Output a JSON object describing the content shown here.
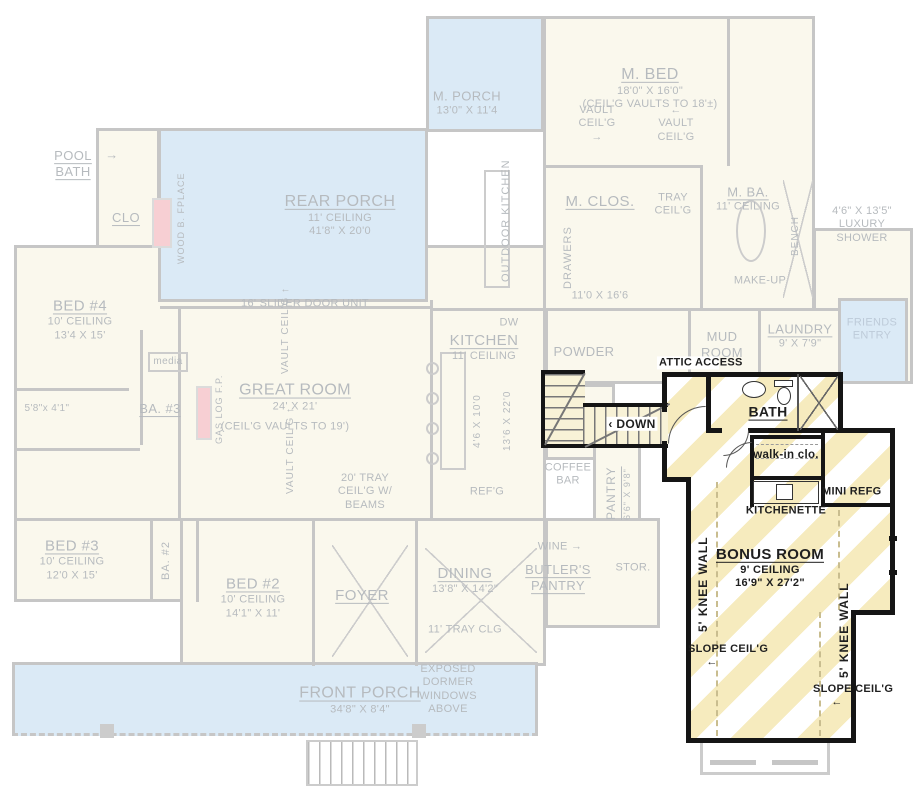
{
  "colors": {
    "highlight_stripe": "#f6ebbe",
    "porch_blue": "#d9e9f6",
    "faded_wall": "#c7c7c7",
    "active_wall": "#151515",
    "fireplace_pink": "#f7ced2",
    "faded_text": "#b8bcbf",
    "active_text": "#1f1f1f"
  },
  "icons": {
    "arrow_right": "→",
    "arrow_left": "←",
    "arrow_up": "↑",
    "arrow_down": "↓",
    "chevron_left": "‹"
  },
  "faded": {
    "m_porch_name": "M. PORCH",
    "m_porch_dims": "13'0\" X 11'4",
    "m_bed_name": "M. BED",
    "m_bed_dims": "18'0\" X 16'0\"",
    "m_bed_note": "(CEIL'G VAULTS TO 18'±)",
    "vault_ceilg": "VAULT CEIL'G",
    "pool_bath": "POOL BATH",
    "clo": "CLO",
    "wood_fplace": "WOOD B. FPLACE",
    "rear_porch_name": "REAR PORCH",
    "rear_porch_ceiling": "11' CEILING",
    "rear_porch_dims": "41'8\" X 20'0",
    "outdoor_kitchen": "OUTDOOR KITCHEN",
    "m_clos_name": "M. CLOS.",
    "drawers": "DRAWERS",
    "m_clos_dims": "11'0 X 16'6",
    "tray_ceilg": "TRAY CEIL'G",
    "m_ba_name": "M. BA.",
    "m_ba_ceiling": "11' CEILING",
    "bench": "BENCH",
    "make_up": "MAKE-UP",
    "shower_note": "4'6\" X 13'5\" LUXURY SHOWER",
    "bed4_name": "BED #4",
    "bed4_ceiling": "10' CEILING",
    "bed4_dims": "13'4 X 15'",
    "slider": "16' SLIDER DOOR UNIT",
    "media": "media",
    "great_room_name": "GREAT ROOM",
    "great_room_dims": "24' X 21'",
    "great_room_note": "(CEIL'G VAULTS TO 19')",
    "ba3_dims": "5'8\"x 4'1\"",
    "ba3_name": "BA. #3",
    "gas_fp": "GAS LOG F.P.",
    "kitchen_name": "KITCHEN",
    "kitchen_ceiling": "11' CEILING",
    "dw": "DW",
    "kitchen_island_dims": "4'6 X 10'0",
    "kitchen_dims": "13'6 X 22'0",
    "powder": "POWDER",
    "mud_room": "MUD ROOM",
    "laundry_name": "LAUNDRY",
    "laundry_dims": "9' X 7'9\"",
    "friends_entry": "FRIENDS ENTRY",
    "coffee_bar": "COFFEE BAR",
    "pantry_name": "PANTRY",
    "pantry_dims": "6'6\" X 9'8\"",
    "refg": "REF'G",
    "tray_beams": "20' TRAY CEIL'G W/ BEAMS",
    "wine": "WINE",
    "butlers": "BUTLER'S PANTRY",
    "stor": "STOR.",
    "bed3_name": "BED #3",
    "bed3_ceiling": "10' CEILING",
    "bed3_dims": "12'0 X 15'",
    "ba2": "BA. #2",
    "bed2_name": "BED #2",
    "bed2_ceiling": "10' CEILING",
    "bed2_dims": "14'1\" X 11'",
    "foyer": "FOYER",
    "dining_name": "DINING",
    "dining_dims": "13'8\" X 14'2\"",
    "dining_note": "11' TRAY CLG",
    "front_porch_name": "FRONT PORCH",
    "front_porch_dims": "34'8\" X 8'4\"",
    "dormer_note": "EXPOSED DORMER WINDOWS ABOVE"
  },
  "active": {
    "attic_access": "ATTIC ACCESS",
    "down": "DOWN",
    "bath": "BATH",
    "walk_in": "walk-in clo.",
    "mini_refg": "MINI REFG",
    "kitchenette": "KITCHENETTE",
    "bonus_name": "BONUS ROOM",
    "bonus_ceiling": "9' CEILING",
    "bonus_dims": "16'9\" X 27'2\"",
    "knee_wall": "5' KNEE WALL",
    "slope_ceilg": "SLOPE CEIL'G"
  }
}
